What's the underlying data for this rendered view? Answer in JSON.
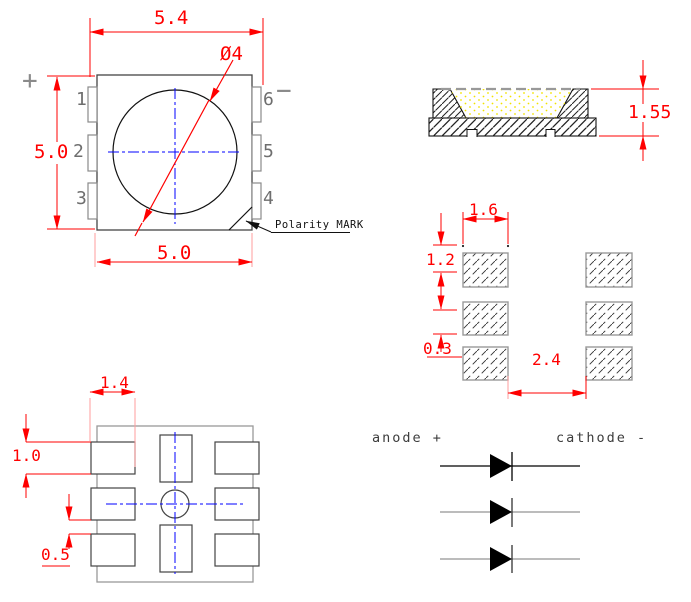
{
  "top_view": {
    "dim_overall_width": "5.4",
    "dim_body_height": "5.0",
    "dim_body_width": "5.0",
    "dim_lens_diameter": "Ø4",
    "polarity_label": "Polarity MARK",
    "plus_symbol": "+",
    "minus_symbol": "−",
    "pins_left": [
      "1",
      "2",
      "3"
    ],
    "pins_right": [
      "6",
      "5",
      "4"
    ]
  },
  "side_view": {
    "dim_height": "1.55"
  },
  "pad_layout": {
    "dim_pad_width": "1.6",
    "dim_pad_height": "1.2",
    "dim_pad_gap": "0.3",
    "dim_column_gap": "2.4"
  },
  "bottom_view": {
    "dim_pad_width": "1.4",
    "dim_pad_height": "1.0",
    "dim_pad_gap": "0.5"
  },
  "schematic": {
    "anode_label": "anode +",
    "cathode_label": "cathode -"
  },
  "colors": {
    "dimension_red": "#ff0000",
    "extension_pink": "#ff9e9e",
    "centerline_blue": "#0000ff",
    "outline_gray": "#808080",
    "line_black": "#000000",
    "encapsulant_yellow": "#f2e300"
  }
}
